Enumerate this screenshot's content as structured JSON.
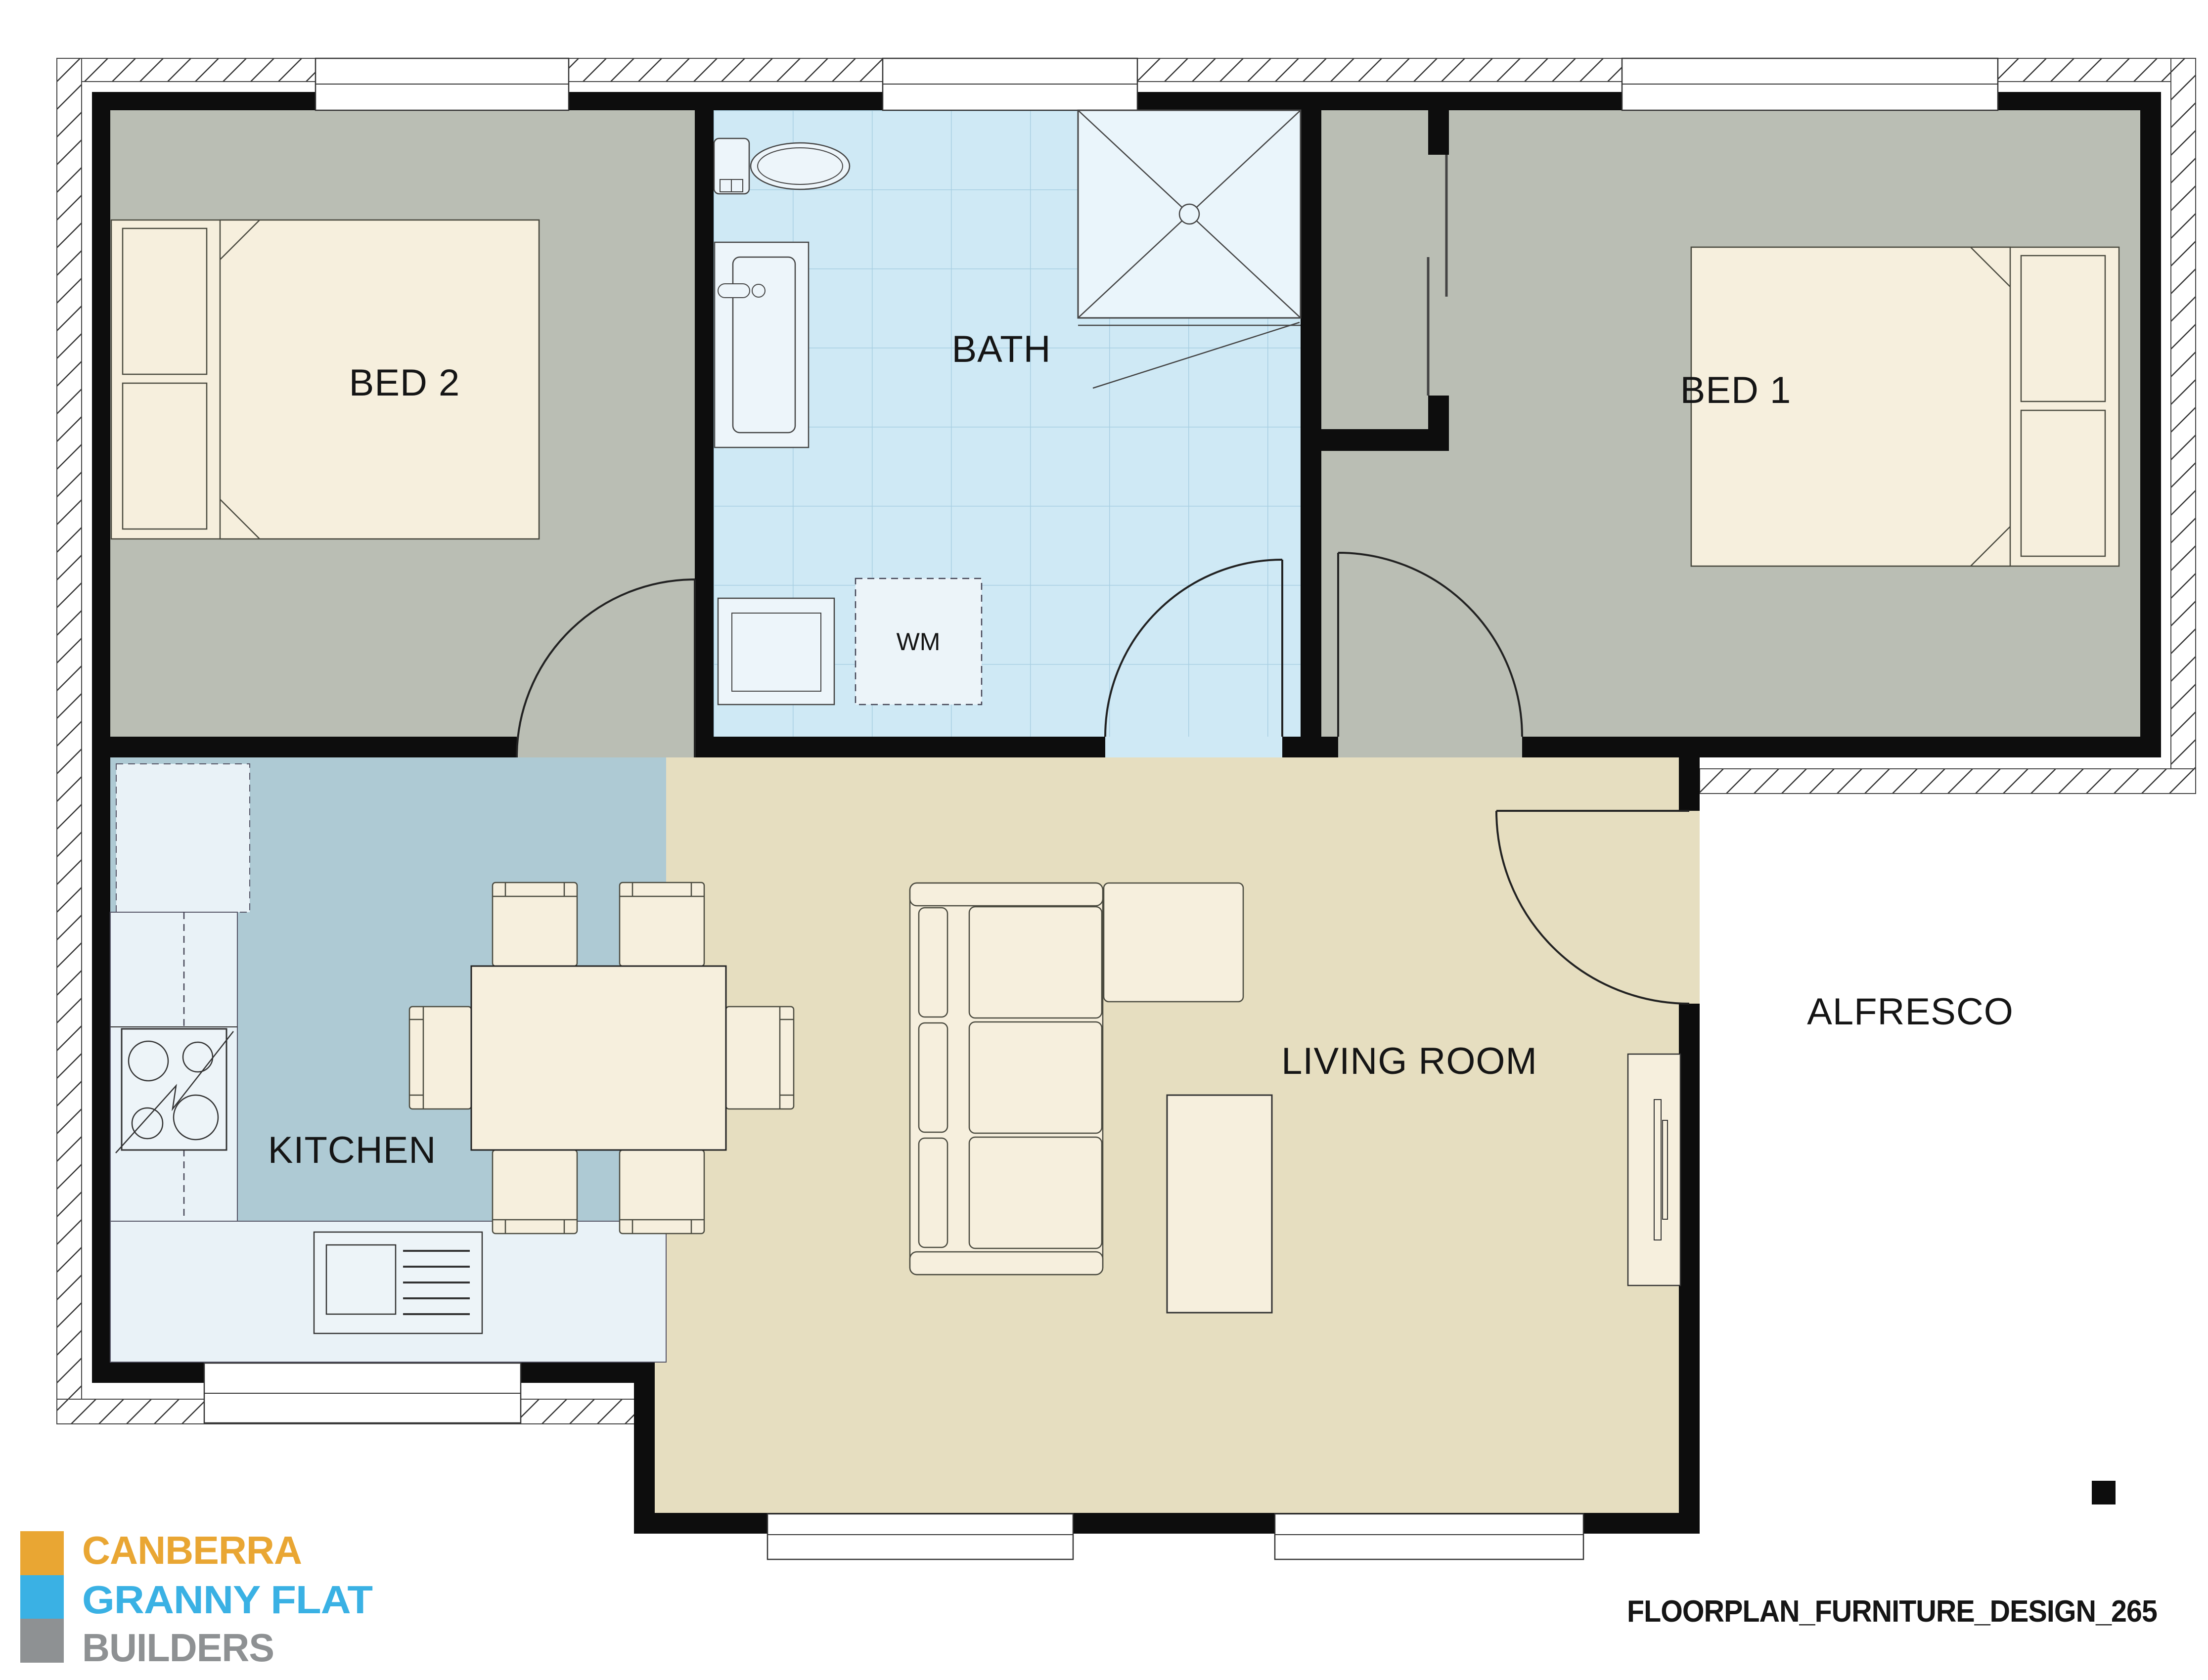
{
  "rooms": {
    "bed2": "BED 2",
    "bath": "BATH",
    "bed1": "BED 1",
    "kitchen": "KITCHEN",
    "living": "LIVING ROOM",
    "alfresco": "ALFRESCO"
  },
  "appliances": {
    "washing_machine": "WM"
  },
  "brand": {
    "word1": "CANBERRA",
    "word2": "GRANNY FLAT",
    "word3": "BUILDERS"
  },
  "footer": {
    "drawing_id": "FLOORPLAN_FURNITURE_DESIGN_265"
  },
  "palette": {
    "wall": "#0d0d0d",
    "bedroom_floor": "#babeb4",
    "bath_floor": "#cfe9f5",
    "kitchen_floor": "#aecad4",
    "living_floor": "#e6dec0",
    "shower": "#eaf5fb",
    "furniture": "#f6efdd",
    "counter": "#e9f2f7",
    "brand_orange": "#E9A633",
    "brand_blue": "#3AB1E4",
    "brand_gray": "#8E9193",
    "text": "#151515"
  }
}
